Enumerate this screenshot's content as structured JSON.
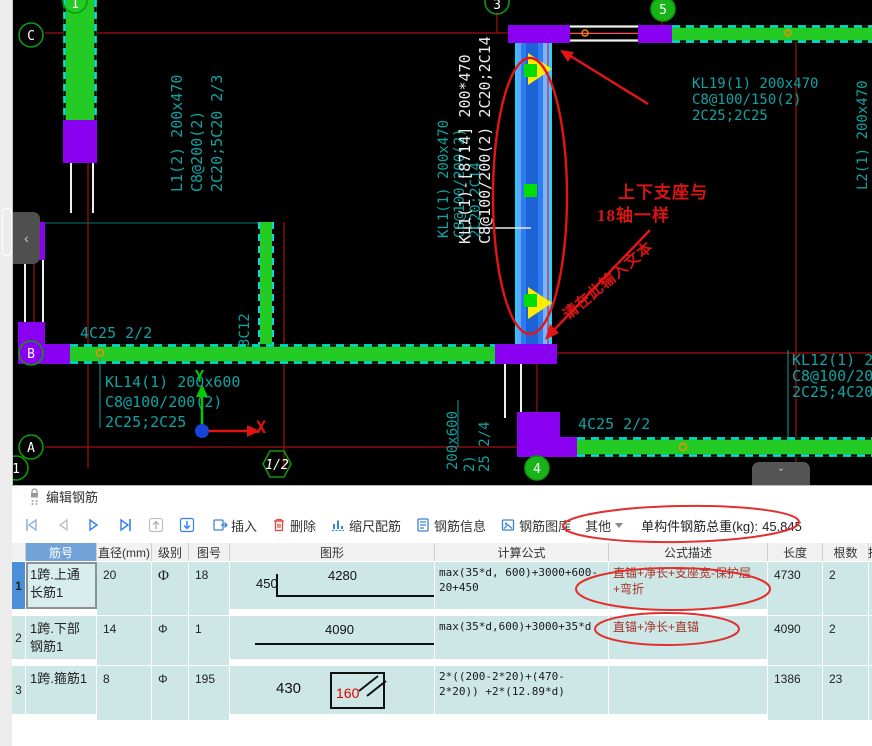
{
  "drawing": {
    "bubbles": {
      "c": "C",
      "b": "B",
      "a": "A",
      "one_top": "1",
      "one_bottom": "1",
      "half": "1/2",
      "three": "3",
      "four": "4",
      "five": "5"
    },
    "labels": {
      "l1_a": "L1(2) 200x470",
      "l1_b": "C8@200(2)",
      "l1_c": "2C20;5C20 2/3",
      "kl1_teal_a": "KL1(1) 200x470",
      "kl1_teal_b": "C8@100/200(2)",
      "kl1_teal_c": "2C20;2C14",
      "kl1_white_a": "KL1(1)-[8714] 200*470",
      "kl1_white_b": "C8@100/200(2) 2C20;2C14",
      "kl19_a": "KL19(1) 200x470",
      "kl19_b": "C8@100/150(2)",
      "kl19_c": "2C25;2C25",
      "l2_right": "L2(1) 200x470",
      "b_beam": "4C25 2/2",
      "mid_stub": "3C12",
      "kl14_a": "KL14(1) 200x600",
      "kl14_b": "C8@100/200(2)",
      "kl14_c": "2C25;2C25",
      "dim_a": "200x600",
      "dim_b": "2)",
      "dim_c": "25 2/4",
      "a_beam": "4C25 2/2",
      "kl12_a": "KL12(1) 200",
      "kl12_b": "C8@100/200(",
      "kl12_c": "2C25;4C20",
      "ucs_x": "X",
      "ucs_y": "Y"
    },
    "annotations": {
      "note1": "上下支座与",
      "note2": "18轴一样",
      "diagonal": "请在此输入文本"
    }
  },
  "panel": {
    "title": "编辑钢筋",
    "toolbar": {
      "insert": "插入",
      "del": "删除",
      "scale_rebar": "缩尺配筋",
      "rebar_info": "钢筋信息",
      "rebar_library": "钢筋图库",
      "other": "其他",
      "weight_label": "单构件钢筋总重(kg):",
      "weight_value": "45.845"
    },
    "table": {
      "headers": [
        "筋号",
        "直径(mm)",
        "级别",
        "图号",
        "图形",
        "计算公式",
        "公式描述",
        "长度",
        "根数",
        "搭"
      ],
      "rows": [
        {
          "num": "1",
          "name": "1跨.上通长筋1",
          "dia": "20",
          "level": "Φ",
          "pic": "18",
          "shape_left": "450",
          "shape_main": "4280",
          "formula": "max(35*d, 600)+3000+600-20+450",
          "desc": "直锚+净长+支座宽-保护层+弯折",
          "length": "4730",
          "count": "2",
          "lap": "0"
        },
        {
          "num": "2",
          "name": "1跨.下部钢筋1",
          "dia": "14",
          "level": "Φ",
          "pic": "1",
          "shape_main": "4090",
          "formula": "max(35*d,600)+3000+35*d",
          "desc": "直锚+净长+直锚",
          "length": "4090",
          "count": "2",
          "lap": "0"
        },
        {
          "num": "3",
          "name": "1跨.箍筋1",
          "dia": "8",
          "level": "Φ",
          "pic": "195",
          "shape_left": "430",
          "shape_inner": "160",
          "formula": "2*((200-2*20)+(470-2*20)) +2*(12.89*d)",
          "desc": "",
          "length": "1386",
          "count": "23",
          "lap": "0"
        }
      ]
    }
  },
  "tabs": {
    "left_chevron": "‹",
    "bottom_chevron": "ˇ"
  },
  "colors": {
    "beam_green": "#25cb25",
    "column_purple": "#8a00f0",
    "selected_blue": "#2e7cf2",
    "axis_red": "#a01010",
    "annotation_red": "#e31515",
    "cad_teal": "#0fa3a3",
    "header_blue": "#71a3d9",
    "row_bg": "#cde7e7"
  }
}
